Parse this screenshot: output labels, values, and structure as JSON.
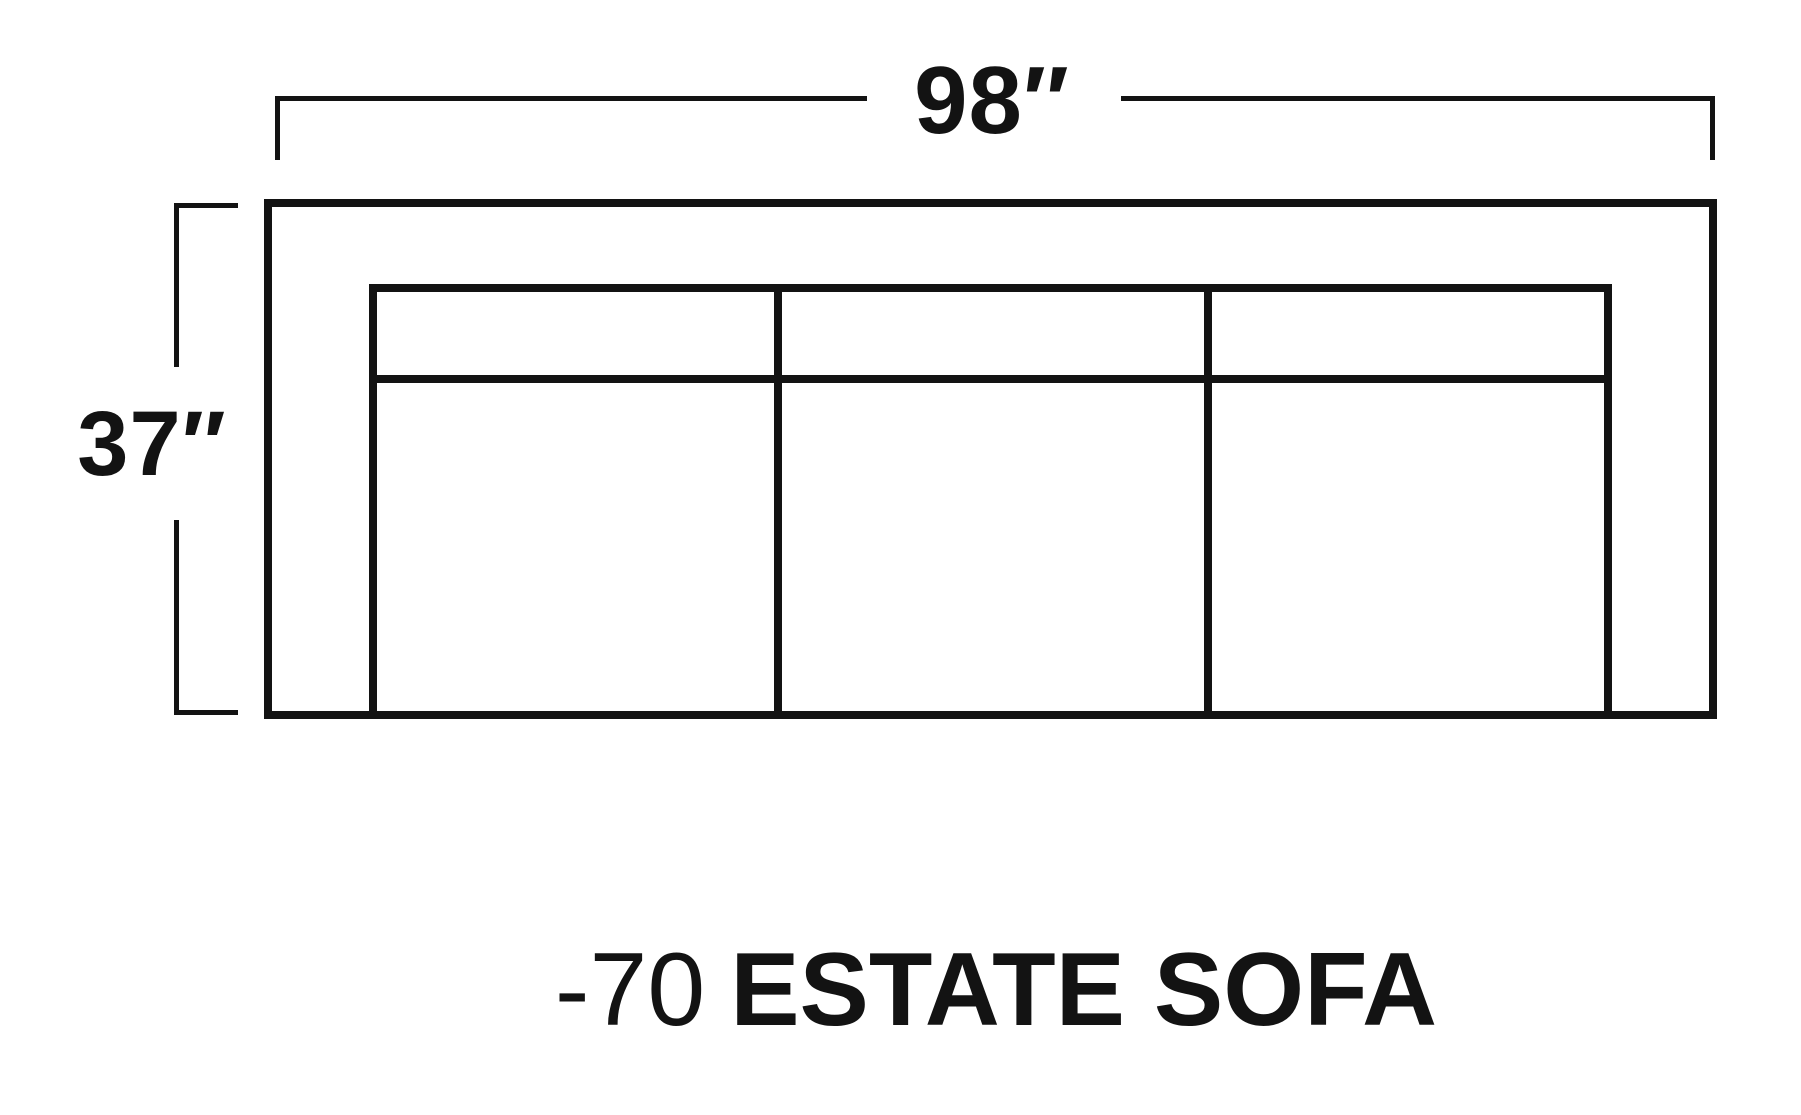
{
  "canvas": {
    "background": "#ffffff",
    "line_color": "#131313"
  },
  "dimensions": {
    "width": {
      "label": "98″"
    },
    "depth": {
      "label": "37″"
    }
  },
  "sofa": {
    "type": "top-view outline",
    "seat_count": 3
  },
  "caption": {
    "model": "-70",
    "name": "ESTATE SOFA"
  }
}
